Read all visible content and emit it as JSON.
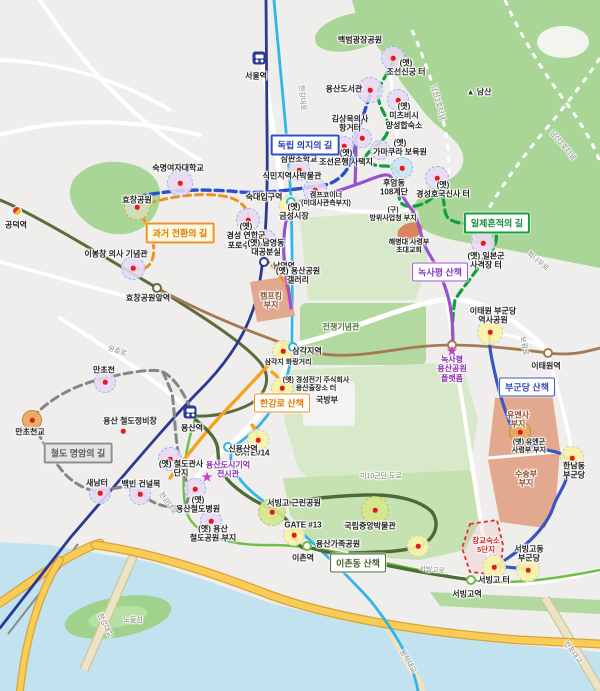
{
  "map": {
    "route_boxes": [
      {
        "t": "과거 전환의 길",
        "x": 180,
        "y": 233,
        "k": "b-to",
        "n": "route-label-past-transition"
      },
      {
        "t": "독립 의지의 길",
        "x": 305,
        "y": 145,
        "k": "b-tb",
        "n": "route-label-independence-will"
      },
      {
        "t": "일제흔적의 길",
        "x": 497,
        "y": 223,
        "k": "b-tg",
        "n": "route-label-colonial-traces"
      },
      {
        "t": "철도 명암의 길",
        "x": 78,
        "y": 453,
        "k": "b-tgr",
        "n": "route-label-railway"
      },
      {
        "t": "한강로 산책",
        "x": 282,
        "y": 403,
        "k": "b-wo",
        "n": "walk-label-hangangro"
      },
      {
        "t": "녹사평 산책",
        "x": 440,
        "y": 272,
        "k": "b-wp",
        "n": "walk-label-noksapyeong"
      },
      {
        "t": "부군당 산책",
        "x": 527,
        "y": 387,
        "k": "b-wb",
        "n": "walk-label-bugundang"
      },
      {
        "t": "이촌동 산책",
        "x": 358,
        "y": 563,
        "k": "b-wg",
        "n": "walk-label-ichondong"
      }
    ],
    "labels": [
      {
        "t": "서울역",
        "x": 256,
        "y": 76
      },
      {
        "t": "공덕역",
        "x": 16,
        "y": 225
      },
      {
        "t": "백범광장공원",
        "x": 360,
        "y": 40
      },
      {
        "t": "(옛)\n조선신궁 터",
        "x": 406,
        "y": 68
      },
      {
        "t": "용산도서관",
        "x": 344,
        "y": 89
      },
      {
        "t": "(옛)\n미츠비시\n양성합숙소",
        "x": 404,
        "y": 116
      },
      {
        "t": "김상옥의사\n항거터",
        "x": 350,
        "y": 124
      },
      {
        "t": "(옛)\n조선은행 사택지",
        "x": 346,
        "y": 158
      },
      {
        "t": "(옛)\n가마쿠라 보육원",
        "x": 400,
        "y": 148
      },
      {
        "t": "▲ 남산",
        "x": 479,
        "y": 92,
        "k": "k-mount"
      },
      {
        "t": "남산3호터널",
        "x": 437,
        "y": 103,
        "r": 75,
        "k": "k-road"
      },
      {
        "t": "남산1호터널",
        "x": 562,
        "y": 146,
        "r": 50,
        "k": "k-road"
      },
      {
        "t": "숙명여자대학교",
        "x": 178,
        "y": 168
      },
      {
        "t": "식민지역사박물관",
        "x": 292,
        "y": 176
      },
      {
        "t": "효창공원",
        "x": 137,
        "y": 200
      },
      {
        "t": "(옛)\n삼판소학교",
        "x": 299,
        "y": 155
      },
      {
        "t": "(옛)\n경성 연합군\n포로수용소",
        "x": 246,
        "y": 236
      },
      {
        "t": "이봉창 의사 기념관",
        "x": 116,
        "y": 254
      },
      {
        "t": "남영역",
        "x": 284,
        "y": 266
      },
      {
        "t": "(옛) 남영동\n대공분실",
        "x": 266,
        "y": 248
      },
      {
        "t": "(옛)\n금성시장",
        "x": 294,
        "y": 212
      },
      {
        "t": "캠프코이너\n(미대사관측부지)",
        "x": 326,
        "y": 200,
        "k": "k-small"
      },
      {
        "t": "(옛) 용산공원\n갤러리",
        "x": 298,
        "y": 276
      },
      {
        "t": "캠프킴\n부지",
        "x": 271,
        "y": 301,
        "k": "k-salmon"
      },
      {
        "t": "전쟁기념관",
        "x": 341,
        "y": 327,
        "k": "k-areagreen"
      },
      {
        "t": "숙대입구역",
        "x": 264,
        "y": 197
      },
      {
        "t": "삼각지역",
        "x": 307,
        "y": 351
      },
      {
        "t": "삼각지 화랑거리",
        "x": 288,
        "y": 363,
        "k": "k-small"
      },
      {
        "t": "(옛) 경성전기 주식회사\n용산출장소 터",
        "x": 316,
        "y": 385,
        "k": "k-small"
      },
      {
        "t": "GATE#14",
        "x": 252,
        "y": 453
      },
      {
        "t": "국방부",
        "x": 327,
        "y": 400
      },
      {
        "t": "미10군단 도로",
        "x": 381,
        "y": 477,
        "k": "k-road"
      },
      {
        "t": "신용산역",
        "x": 243,
        "y": 449
      },
      {
        "t": "용산역",
        "x": 192,
        "y": 428
      },
      {
        "t": "(옛) 철도관사\n단지",
        "x": 181,
        "y": 469
      },
      {
        "t": "(옛)\n용산철도병원",
        "x": 198,
        "y": 505
      },
      {
        "t": "(옛) 용산\n철도공원 부지",
        "x": 213,
        "y": 534
      },
      {
        "t": "효창공원앞역",
        "x": 148,
        "y": 298
      },
      {
        "t": "용산 철도정비창",
        "x": 130,
        "y": 421
      },
      {
        "t": "만초천",
        "x": 104,
        "y": 370
      },
      {
        "t": "만초천교",
        "x": 30,
        "y": 432
      },
      {
        "t": "새남터",
        "x": 97,
        "y": 483
      },
      {
        "t": "백빈 건널목",
        "x": 141,
        "y": 484
      },
      {
        "t": "원효로",
        "x": 117,
        "y": 352,
        "r": 18,
        "k": "k-road"
      },
      {
        "t": "한강대로",
        "x": 301,
        "y": 98,
        "r": 85,
        "k": "k-road"
      },
      {
        "t": "한강대로",
        "x": 167,
        "y": 504,
        "r": 55,
        "k": "k-road"
      },
      {
        "t": "노들섬",
        "x": 133,
        "y": 621,
        "k": "k-road"
      },
      {
        "t": "한강대교",
        "x": 104,
        "y": 626,
        "r": 65,
        "k": "k-road"
      },
      {
        "t": "동작대교",
        "x": 407,
        "y": 662,
        "r": 60,
        "k": "k-road"
      },
      {
        "t": "반포대교",
        "x": 572,
        "y": 653,
        "r": 55,
        "k": "k-road"
      },
      {
        "t": "이촌역",
        "x": 303,
        "y": 558
      },
      {
        "t": "서빙고역",
        "x": 467,
        "y": 594
      },
      {
        "t": "서빙고로",
        "x": 432,
        "y": 571,
        "r": 6,
        "k": "k-road"
      },
      {
        "t": "후암동\n108계단",
        "x": 394,
        "y": 188
      },
      {
        "t": "(옛)\n경성호국신사 터",
        "x": 443,
        "y": 190
      },
      {
        "t": "(구)\n방위사업청 부지",
        "x": 393,
        "y": 215,
        "k": "k-small"
      },
      {
        "t": "해병대 사령부\n초대교회",
        "x": 409,
        "y": 247,
        "k": "k-small"
      },
      {
        "t": "(옛) 일본군\n사격장 터",
        "x": 486,
        "y": 261
      },
      {
        "t": "회나무로",
        "x": 537,
        "y": 262,
        "r": 40,
        "k": "k-road"
      },
      {
        "t": "보광로",
        "x": 523,
        "y": 346,
        "r": 80,
        "k": "k-road"
      },
      {
        "t": "이태원역",
        "x": 546,
        "y": 366
      },
      {
        "t": "이태원 부군당\n역사공원",
        "x": 493,
        "y": 316
      },
      {
        "t": "유엔사\n부지",
        "x": 518,
        "y": 420,
        "k": "k-salmon"
      },
      {
        "t": "(옛) 유엔군\n사령부 부지",
        "x": 529,
        "y": 447,
        "k": "k-small"
      },
      {
        "t": "수송부\n부지",
        "x": 526,
        "y": 479,
        "k": "k-salmon"
      },
      {
        "t": "한남동\n부군당",
        "x": 574,
        "y": 471
      },
      {
        "t": "장교숙소\n5단지",
        "x": 486,
        "y": 546,
        "k": "k-red"
      },
      {
        "t": "서빙고동\n부군당",
        "x": 529,
        "y": 554
      },
      {
        "t": "서빙고 터",
        "x": 494,
        "y": 580
      },
      {
        "t": "국립중앙박물관",
        "x": 370,
        "y": 526
      },
      {
        "t": "용산가족공원",
        "x": 338,
        "y": 544
      },
      {
        "t": "서빙고 근린공원",
        "x": 294,
        "y": 503
      },
      {
        "t": "GATE #13",
        "x": 303,
        "y": 525
      },
      {
        "t": "녹사평\n용산공원\n플랫폼",
        "x": 452,
        "y": 369,
        "k": "k-purple"
      },
      {
        "t": "★",
        "x": 452,
        "y": 351,
        "k": "k-star"
      },
      {
        "t": "용산도시기억\n전시관",
        "x": 228,
        "y": 470,
        "k": "k-purple"
      },
      {
        "t": "★",
        "x": 207,
        "y": 477,
        "k": "k-star"
      }
    ],
    "pois": [
      {
        "v": "grn",
        "x": 137,
        "y": 207,
        "rr": 13
      },
      {
        "v": "lav",
        "x": 180,
        "y": 183,
        "rr": 13
      },
      {
        "v": "lav",
        "x": 315,
        "y": 190,
        "rr": 12
      },
      {
        "v": "lav",
        "x": 393,
        "y": 58,
        "rr": 12
      },
      {
        "v": "lav",
        "x": 370,
        "y": 90,
        "rr": 13
      },
      {
        "v": "lav",
        "x": 398,
        "y": 100,
        "rr": 11
      },
      {
        "v": "lav",
        "x": 362,
        "y": 138,
        "rr": 10
      },
      {
        "v": "lav",
        "x": 344,
        "y": 146,
        "rr": 10
      },
      {
        "v": "lav",
        "x": 380,
        "y": 150,
        "rr": 10
      },
      {
        "v": "lav",
        "x": 299,
        "y": 170,
        "rr": 11
      },
      {
        "v": "lav",
        "x": 248,
        "y": 220,
        "rr": 12
      },
      {
        "v": "lav",
        "x": 133,
        "y": 268,
        "rr": 12
      },
      {
        "v": "lav",
        "x": 265,
        "y": 240,
        "rr": 11
      },
      {
        "v": "lav",
        "x": 105,
        "y": 382,
        "rr": 11
      },
      {
        "v": "lav",
        "x": 100,
        "y": 493,
        "rr": 11
      },
      {
        "v": "lav",
        "x": 140,
        "y": 494,
        "rr": 11
      },
      {
        "v": "lav",
        "x": 170,
        "y": 459,
        "rr": 12
      },
      {
        "v": "lav",
        "x": 195,
        "y": 489,
        "rr": 11
      },
      {
        "v": "lav",
        "x": 211,
        "y": 521,
        "rr": 11
      },
      {
        "v": "lav",
        "x": 483,
        "y": 243,
        "rr": 12
      },
      {
        "v": "lav",
        "x": 437,
        "y": 178,
        "rr": 12
      },
      {
        "v": "blue",
        "x": 402,
        "y": 168,
        "rr": 11
      },
      {
        "v": "yel",
        "x": 290,
        "y": 206,
        "rr": 11
      },
      {
        "v": "yel",
        "x": 283,
        "y": 351,
        "rr": 11
      },
      {
        "v": "yel",
        "x": 282,
        "y": 388,
        "rr": 11
      },
      {
        "v": "yel",
        "x": 258,
        "y": 440,
        "rr": 11
      },
      {
        "v": "yel",
        "x": 294,
        "y": 535,
        "rr": 11
      },
      {
        "v": "yel",
        "x": 490,
        "y": 332,
        "rr": 13
      },
      {
        "v": "yel",
        "x": 572,
        "y": 458,
        "rr": 12
      },
      {
        "v": "yel",
        "x": 528,
        "y": 570,
        "rr": 12
      },
      {
        "v": "yel",
        "x": 494,
        "y": 567,
        "rr": 12
      },
      {
        "v": "yel",
        "x": 418,
        "y": 546,
        "rr": 11
      },
      {
        "v": "lime",
        "x": 272,
        "y": 512,
        "rr": 14
      },
      {
        "v": "lime",
        "x": 375,
        "y": 510,
        "rr": 14
      },
      {
        "v": "tan",
        "x": 520,
        "y": 432,
        "rr": 11
      },
      {
        "v": "tan",
        "x": 32,
        "y": 420,
        "rr": 10
      },
      {
        "v": "dotonly",
        "x": 123,
        "y": 431,
        "rr": 4
      }
    ],
    "stations": [
      {
        "v": "train",
        "x": 259,
        "y": 58,
        "n": "station-seoul"
      },
      {
        "v": "train",
        "x": 190,
        "y": 412,
        "n": "station-yongsan"
      },
      {
        "v": "dual",
        "x": 17,
        "y": 211,
        "n": "station-gongdeok"
      },
      {
        "v": "ring",
        "x": 157,
        "y": 288,
        "c": "#5d6b3a",
        "n": "station-hyochang-park"
      },
      {
        "v": "ring",
        "x": 291,
        "y": 202,
        "c": "#33b5e5",
        "n": "station-sookdae-ipgu"
      },
      {
        "v": "ring",
        "x": 264,
        "y": 262,
        "c": "#2b3990",
        "n": "station-namyeong"
      },
      {
        "v": "ring",
        "x": 293,
        "y": 347,
        "c": "#33b5e5",
        "n": "station-samgakji"
      },
      {
        "v": "ring",
        "x": 228,
        "y": 447,
        "c": "#33b5e5",
        "n": "station-sinyongsan"
      },
      {
        "v": "ring",
        "x": 548,
        "y": 353,
        "c": "#a57a52",
        "n": "station-itaewon"
      },
      {
        "v": "ring",
        "x": 452,
        "y": 345,
        "c": "#a57a52",
        "n": "station-noksapyeong"
      },
      {
        "v": "ring",
        "x": 307,
        "y": 546,
        "c": "#6fbf44",
        "n": "station-ichon"
      },
      {
        "v": "ring",
        "x": 471,
        "y": 580,
        "c": "#6fbf44",
        "n": "station-seobinggo"
      }
    ]
  }
}
